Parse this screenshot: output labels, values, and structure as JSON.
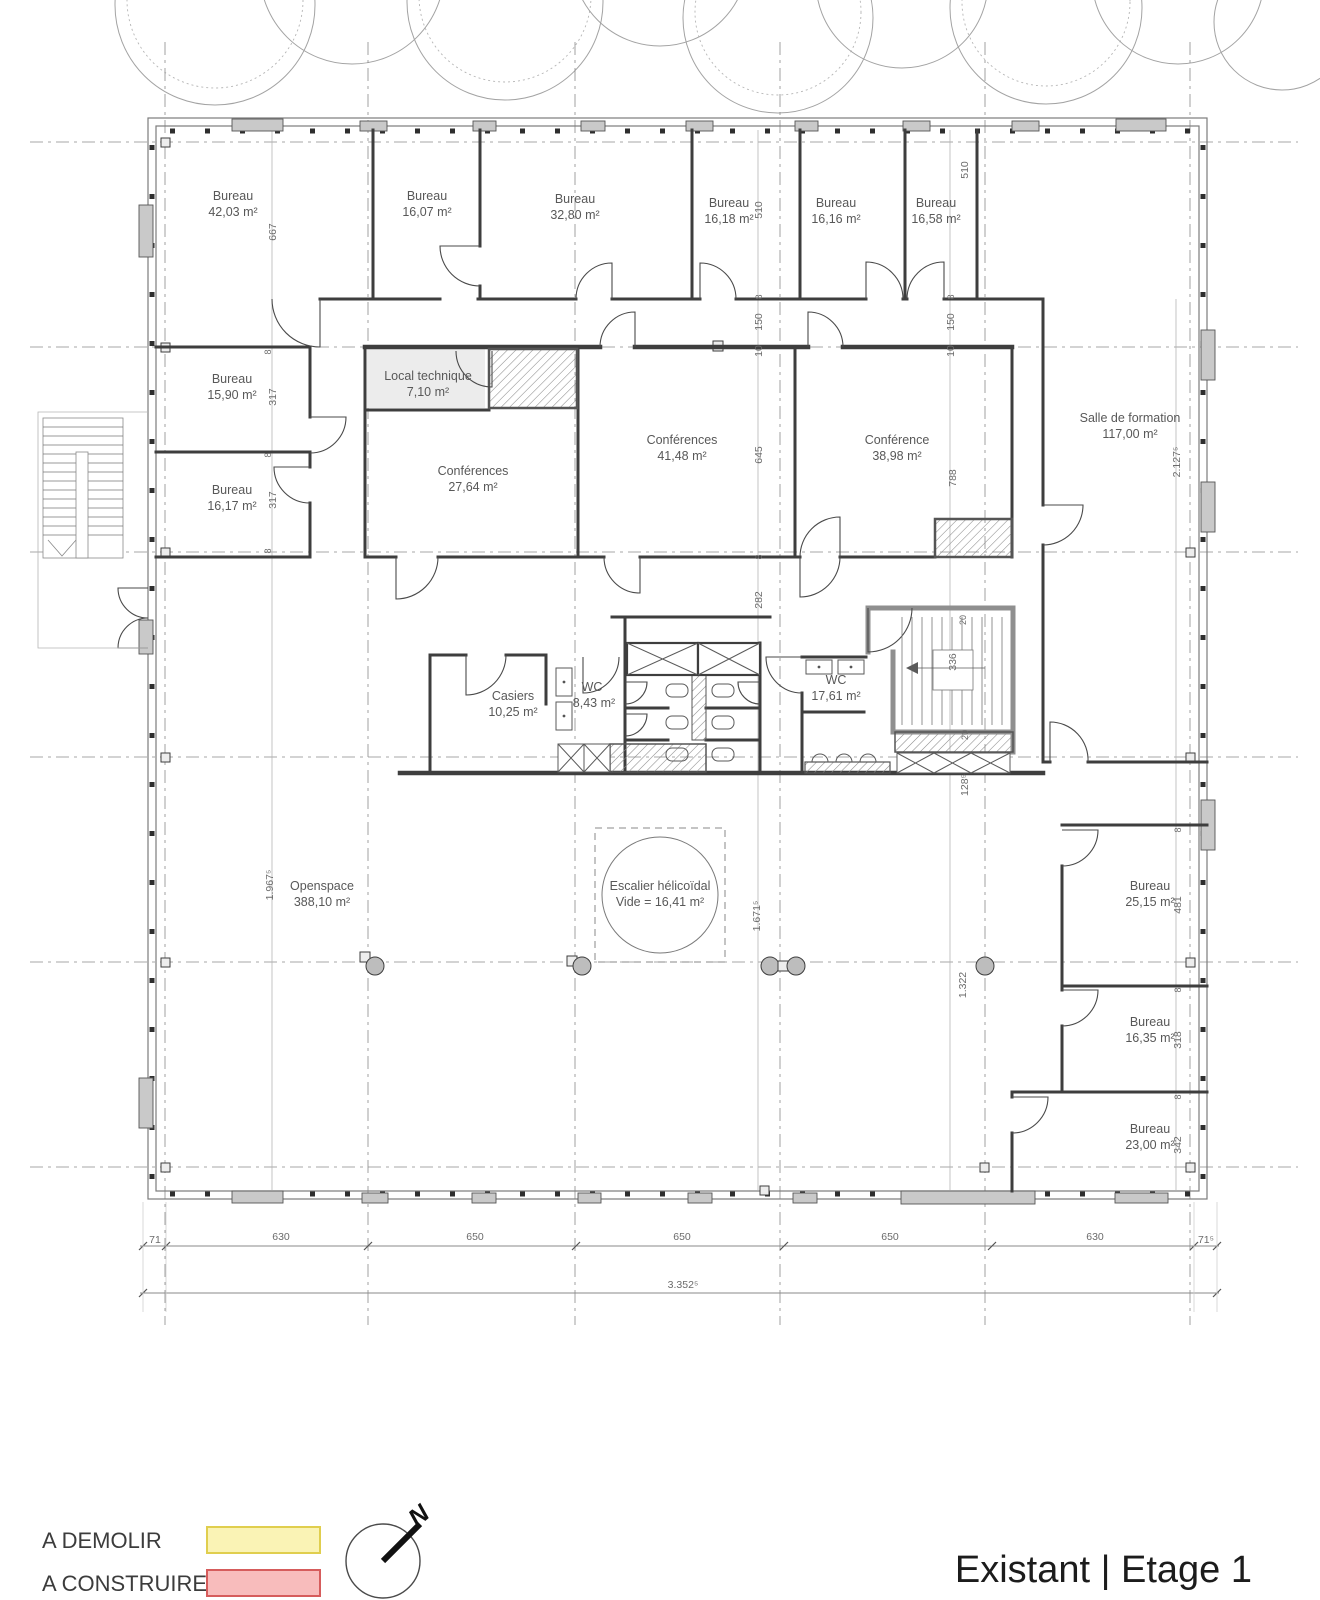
{
  "title": "Existant | Etage 1",
  "legend": {
    "items": [
      {
        "label": "A DEMOLIR",
        "fill": "#FAF3B5",
        "border": "#E0CE4E"
      },
      {
        "label": "A CONSTRUIRE",
        "fill": "#F8BCBC",
        "border": "#D65C5C"
      }
    ]
  },
  "compass": {
    "north_label": "N"
  },
  "rooms": [
    {
      "name": "Bureau",
      "area": "42,03 m²"
    },
    {
      "name": "Bureau",
      "area": "16,07 m²"
    },
    {
      "name": "Bureau",
      "area": "32,80 m²"
    },
    {
      "name": "Bureau",
      "area": "16,18 m²"
    },
    {
      "name": "Bureau",
      "area": "16,16 m²"
    },
    {
      "name": "Bureau",
      "area": "16,58 m²"
    },
    {
      "name": "Bureau",
      "area": "15,90 m²"
    },
    {
      "name": "Bureau",
      "area": "16,17 m²"
    },
    {
      "name": "Local technique",
      "area": "7,10 m²"
    },
    {
      "name": "Conférences",
      "area": "27,64 m²"
    },
    {
      "name": "Conférences",
      "area": "41,48 m²"
    },
    {
      "name": "Conférence",
      "area": "38,98 m²"
    },
    {
      "name": "Salle de formation",
      "area": "117,00 m²"
    },
    {
      "name": "Casiers",
      "area": "10,25 m²"
    },
    {
      "name": "WC",
      "area": "8,43 m²"
    },
    {
      "name": "WC",
      "area": "17,61 m²"
    },
    {
      "name": "Openspace",
      "area": "388,10 m²"
    },
    {
      "name": "Escalier hélicoïdal",
      "area": "Vide = 16,41 m²"
    },
    {
      "name": "Bureau",
      "area": "25,15 m²"
    },
    {
      "name": "Bureau",
      "area": "16,35 m²"
    },
    {
      "name": "Bureau",
      "area": "23,00 m²"
    }
  ],
  "dims": {
    "vertical": [
      "667",
      "317",
      "317",
      "8",
      "8",
      "8",
      "510",
      "510",
      "8",
      "150",
      "10",
      "8",
      "150",
      "10",
      "645",
      "788",
      "8",
      "282",
      "2.127⁵",
      "20",
      "336",
      "20",
      "128⁵",
      "1.967⁵",
      "1.671⁵",
      "1.322",
      "8",
      "481",
      "8",
      "318",
      "8",
      "342"
    ],
    "bottom": [
      "71",
      "630",
      "650",
      "650",
      "650",
      "630",
      "71⁵"
    ],
    "total": "3.352⁵"
  }
}
